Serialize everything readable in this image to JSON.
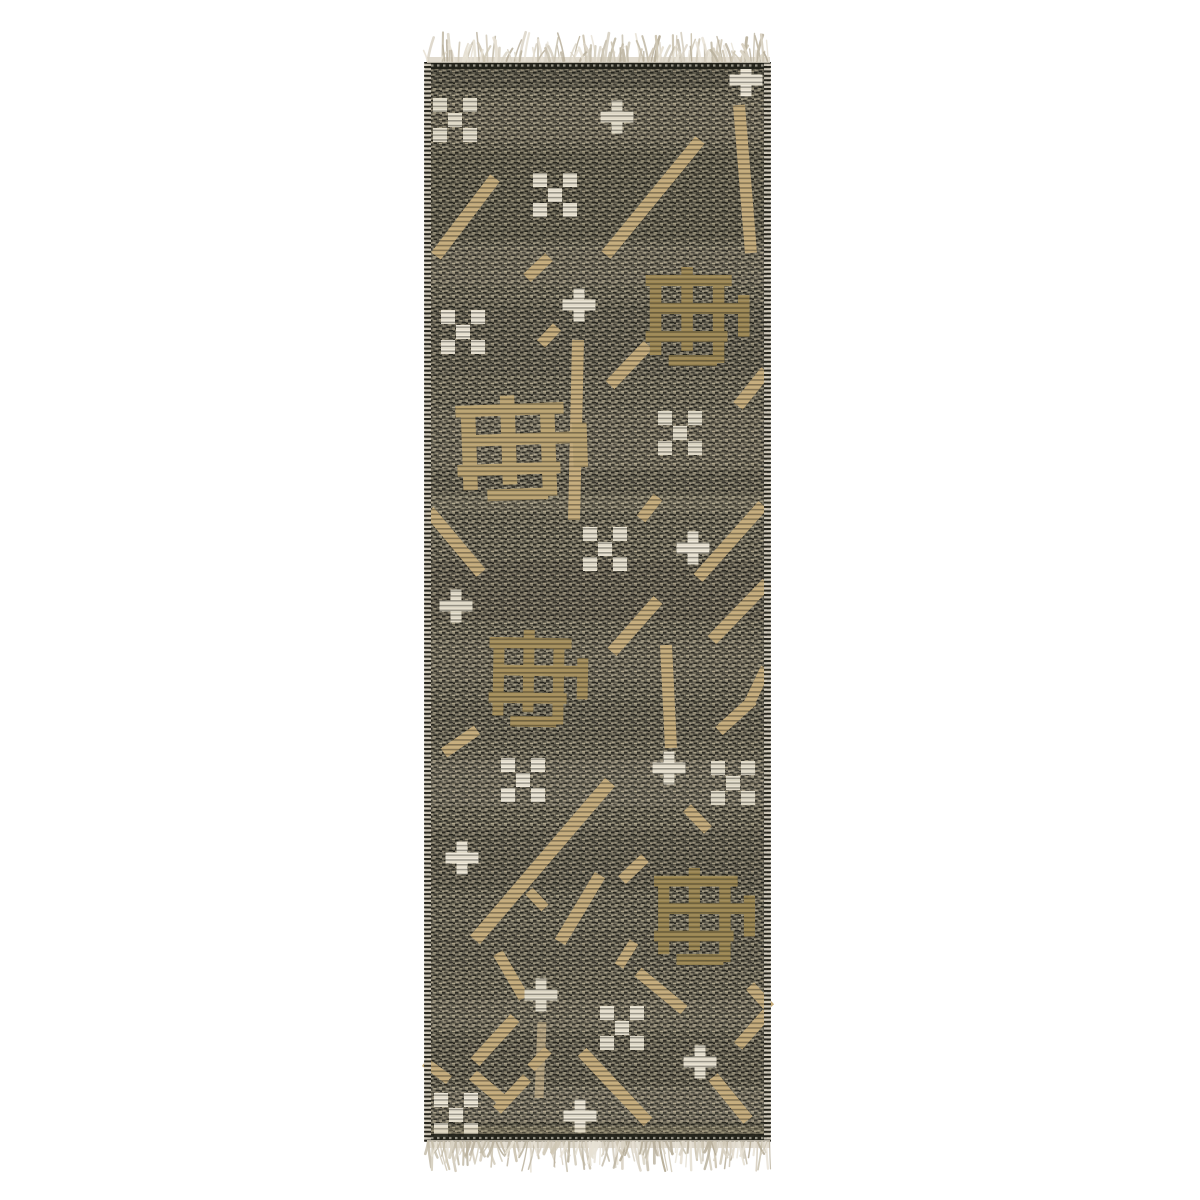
{
  "image": {
    "description": "Product photo of a handwoven charcoal flatweave runner rug with tan diagonal dashes, tan woven grid motifs, cream plus-sign and checkered-dot accents, and cream fringe tassels at top and bottom on a white background",
    "background": "#ffffff",
    "width": 1200,
    "height": 1200
  },
  "rug": {
    "frame": {
      "x": 425,
      "y": 62,
      "width": 345,
      "height": 1080
    },
    "colors": {
      "base": "#6b6759",
      "dark": "#23221b",
      "fleck": "#b4aa90",
      "tan": "#c8ae7d",
      "olive": "#9e8854",
      "cream": "#ece6d6",
      "fringe": "#d8d1c2",
      "edge": "#201f18",
      "band_light": "#e8dfc6",
      "band_dark": "#11100d"
    },
    "bands": [
      {
        "y": 62,
        "h": 26,
        "c": "#1c1b16",
        "o": 0.18
      },
      {
        "y": 100,
        "h": 40,
        "c": "#e8dfc6",
        "o": 0.05
      },
      {
        "y": 150,
        "h": 90,
        "c": "#11100d",
        "o": 0.1
      },
      {
        "y": 246,
        "h": 40,
        "c": "#e8dfc6",
        "o": 0.06
      },
      {
        "y": 305,
        "h": 70,
        "c": "#11100d",
        "o": 0.08
      },
      {
        "y": 410,
        "h": 60,
        "c": "#e8dfc6",
        "o": 0.05
      },
      {
        "y": 470,
        "h": 24,
        "c": "#11100d",
        "o": 0.06
      },
      {
        "y": 495,
        "h": 16,
        "c": "#e8dfc6",
        "o": 0.1
      },
      {
        "y": 560,
        "h": 60,
        "c": "#11100d",
        "o": 0.09
      },
      {
        "y": 640,
        "h": 40,
        "c": "#e8dfc6",
        "o": 0.05
      },
      {
        "y": 700,
        "h": 40,
        "c": "#11100d",
        "o": 0.06
      },
      {
        "y": 760,
        "h": 46,
        "c": "#e8dfc6",
        "o": 0.08
      },
      {
        "y": 830,
        "h": 60,
        "c": "#11100d",
        "o": 0.08
      },
      {
        "y": 930,
        "h": 40,
        "c": "#11100d",
        "o": 0.05
      },
      {
        "y": 1000,
        "h": 30,
        "c": "#e8dfc6",
        "o": 0.06
      },
      {
        "y": 1035,
        "h": 50,
        "c": "#11100d",
        "o": 0.07
      },
      {
        "y": 1088,
        "h": 34,
        "c": "#e8dfc6",
        "o": 0.08
      },
      {
        "y": 1122,
        "h": 14,
        "c": "#11100d",
        "o": 0.1
      }
    ],
    "motifs": {
      "crosses": [
        [
          746,
          80
        ],
        [
          617,
          117
        ],
        [
          579,
          305
        ],
        [
          693,
          548
        ],
        [
          456,
          606
        ],
        [
          669,
          768
        ],
        [
          462,
          858
        ],
        [
          541,
          995
        ],
        [
          700,
          1062
        ],
        [
          580,
          1116
        ]
      ],
      "checkers": [
        [
          455,
          120
        ],
        [
          555,
          195
        ],
        [
          463,
          332
        ],
        [
          680,
          433
        ],
        [
          605,
          549
        ],
        [
          523,
          780
        ],
        [
          733,
          783
        ],
        [
          622,
          1028
        ],
        [
          456,
          1115
        ]
      ],
      "hashes": [
        {
          "x": 696,
          "y": 315,
          "sx": 1.05,
          "sy": 1.0,
          "r": 0,
          "c": "#9e8854"
        },
        {
          "x": 520,
          "y": 446,
          "sx": 1.32,
          "sy": 1.06,
          "r": -2,
          "c": "#bda573"
        },
        {
          "x": 537,
          "y": 677,
          "sx": 1.0,
          "sy": 0.98,
          "r": 1,
          "c": "#a68f5b"
        },
        {
          "x": 703,
          "y": 915,
          "sx": 1.02,
          "sy": 0.98,
          "r": 0,
          "c": "#9c8752"
        }
      ],
      "lines": [
        [
          739,
          105,
          751,
          253,
          12
        ],
        [
          700,
          140,
          606,
          255,
          12
        ],
        [
          495,
          178,
          436,
          256,
          12
        ],
        [
          549,
          257,
          527,
          278,
          11
        ],
        [
          557,
          327,
          541,
          344,
          11
        ],
        [
          578,
          340,
          574,
          520,
          12
        ],
        [
          648,
          345,
          610,
          385,
          12
        ],
        [
          766,
          371,
          738,
          406,
          12
        ],
        [
          763,
          505,
          698,
          578,
          12
        ],
        [
          658,
          497,
          641,
          519,
          11
        ],
        [
          429,
          511,
          481,
          573,
          12
        ],
        [
          767,
          583,
          712,
          640,
          12
        ],
        [
          658,
          600,
          612,
          652,
          12
        ],
        [
          666,
          645,
          671,
          748,
          12
        ],
        [
          766,
          668,
          748,
          706,
          11
        ],
        [
          753,
          700,
          719,
          731,
          11
        ],
        [
          477,
          730,
          444,
          753,
          11
        ],
        [
          610,
          782,
          475,
          940,
          13
        ],
        [
          600,
          875,
          560,
          942,
          12
        ],
        [
          645,
          858,
          622,
          880,
          11
        ],
        [
          687,
          808,
          708,
          830,
          11
        ],
        [
          529,
          891,
          545,
          908,
          10
        ],
        [
          498,
          953,
          524,
          998,
          11
        ],
        [
          634,
          942,
          619,
          966,
          10
        ],
        [
          638,
          972,
          684,
          1010,
          11
        ],
        [
          750,
          986,
          770,
          1008,
          11
        ],
        [
          515,
          1018,
          475,
          1062,
          12
        ],
        [
          542,
          1022,
          539,
          1098,
          9,
          "#cdb891",
          0.8
        ],
        [
          425,
          1062,
          449,
          1080,
          10
        ],
        [
          473,
          1075,
          507,
          1104,
          12
        ],
        [
          527,
          1078,
          497,
          1110,
          11
        ],
        [
          582,
          1052,
          648,
          1122,
          12
        ],
        [
          548,
          1050,
          531,
          1068,
          10
        ],
        [
          713,
          1077,
          748,
          1120,
          12
        ],
        [
          767,
          1013,
          738,
          1046,
          11
        ]
      ],
      "cream_shades": [
        "#efe9da",
        "#e7e1d0",
        "#ece6d6"
      ]
    },
    "fringe": {
      "seed": 7,
      "x1": 427,
      "x2": 770,
      "top": {
        "y": 63,
        "dir": -1,
        "min": 15,
        "max": 29
      },
      "bottom": {
        "y": 1140,
        "dir": 1,
        "min": 18,
        "max": 30
      },
      "colors": [
        "#d9d2c3",
        "#cfc7b5",
        "#c3bba8",
        "#e7e1d4",
        "#b9b09c"
      ]
    }
  }
}
